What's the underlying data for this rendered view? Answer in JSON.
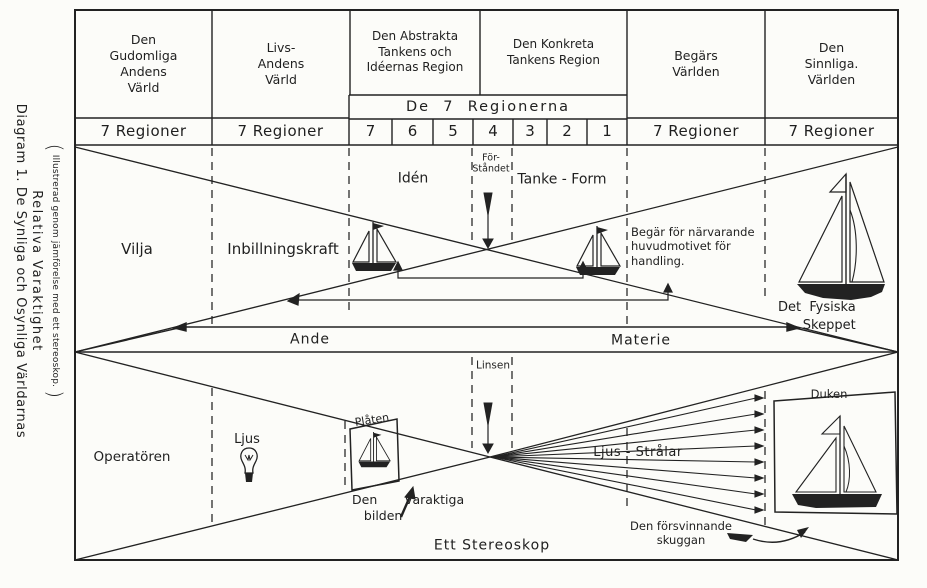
{
  "colors": {
    "ink": "#1f1f1f",
    "paper": "#fcfcf9"
  },
  "side_title": {
    "line1": "Diagram 1. De  Synliga  och  Osynliga  Världarnas",
    "line2": "Relativa  Varaktighet",
    "open_paren": "(",
    "line3": "Illustrerad genom jämförelse med ett stereoskop.",
    "close_paren": ")"
  },
  "header": {
    "col1": "Den\nGudomliga\nAndens\nVärld",
    "col2": "Livs-\nAndens\nVärld",
    "col3": "Den Abstrakta\nTankens och\nIdéernas Region",
    "col4": "Den Konkreta\nTankens Region",
    "col5": "Begärs\nVärlden",
    "col6": "Den\nSinnliga.\nVärlden",
    "sub_header": "De  7  Regionerna",
    "region_numbers": [
      "7",
      "6",
      "5",
      "4",
      "3",
      "2",
      "1"
    ],
    "regioner_label": "7 Regioner"
  },
  "upper": {
    "vilja": "Vilja",
    "inbillningskraft": "Inbillningskraft",
    "iden": "Idén",
    "forstandet": "För-\nStåndet",
    "tanke_form": "Tanke - Form",
    "begar": "Begär för närvarande\nhuvudmotivet för\nhandling.",
    "fysiska_skeppet": "Det  Fysiska\n      Skeppet",
    "ande": "Ande",
    "materie": "Materie"
  },
  "lower": {
    "operatoren": "Operatören",
    "ljus": "Ljus",
    "platen": "Plåten",
    "linsen": "Linsen",
    "varaktiga_bilden": "Den       varaktiga\n   bilden",
    "ljus_stralar": "Ljus - Strålar",
    "forsvinnande": "Den försvinnande\nskuggan",
    "ett_stereoskop": "Ett Stereoskop",
    "duken": "Duken"
  }
}
